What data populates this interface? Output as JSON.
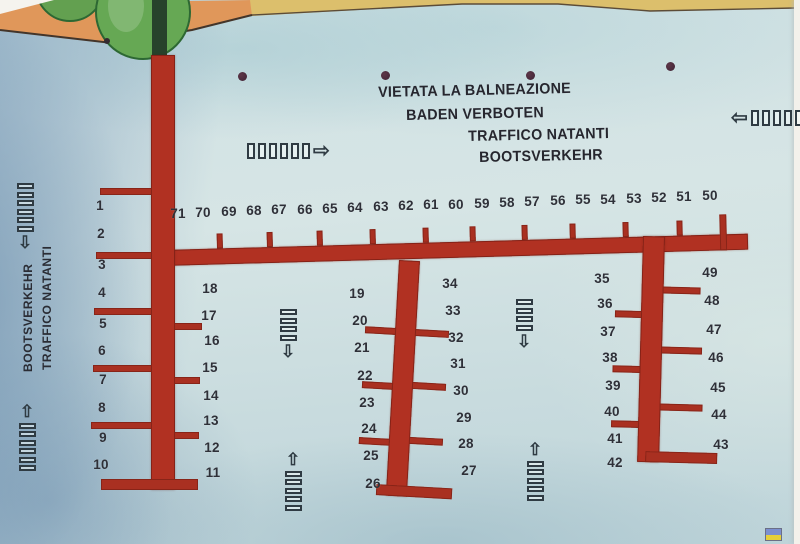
{
  "notice": {
    "lines": [
      {
        "text": "VIETATA LA BALNEAZIONE",
        "x": 378,
        "y": 84
      },
      {
        "text": "BADEN VERBOTEN",
        "x": 406,
        "y": 107
      },
      {
        "text": "TRAFFICO NATANTI",
        "x": 468,
        "y": 128
      },
      {
        "text": "BOOTSVERKEHR",
        "x": 479,
        "y": 149
      }
    ]
  },
  "side_label": {
    "lines": [
      "TRAFFICO NATANTI",
      "BOOTSVERKEHR"
    ]
  },
  "glyphs": {
    "up": "⇧",
    "down": "⇩",
    "left": "⇦",
    "right": "⇨"
  },
  "colors": {
    "water": "#cfe0e3",
    "water_deep": "#7fa3bf",
    "land": "#e0975a",
    "sand": "#dcbf6c",
    "tree": "#66a854",
    "pier": "#b13122",
    "ink": "#2e3038"
  },
  "berth_groups": [
    {
      "name": "berths-north-row",
      "items": [
        {
          "label": "71",
          "x": 178,
          "y": 206
        },
        {
          "label": "70",
          "x": 203,
          "y": 205
        },
        {
          "label": "69",
          "x": 229,
          "y": 204
        },
        {
          "label": "68",
          "x": 254,
          "y": 203
        },
        {
          "label": "67",
          "x": 279,
          "y": 202
        },
        {
          "label": "66",
          "x": 305,
          "y": 202
        },
        {
          "label": "65",
          "x": 330,
          "y": 201
        },
        {
          "label": "64",
          "x": 355,
          "y": 200
        },
        {
          "label": "63",
          "x": 381,
          "y": 199
        },
        {
          "label": "62",
          "x": 406,
          "y": 198
        },
        {
          "label": "61",
          "x": 431,
          "y": 197
        },
        {
          "label": "60",
          "x": 456,
          "y": 197
        },
        {
          "label": "59",
          "x": 482,
          "y": 196
        },
        {
          "label": "58",
          "x": 507,
          "y": 195
        },
        {
          "label": "57",
          "x": 532,
          "y": 194
        },
        {
          "label": "56",
          "x": 558,
          "y": 193
        },
        {
          "label": "55",
          "x": 583,
          "y": 192
        },
        {
          "label": "54",
          "x": 608,
          "y": 192
        },
        {
          "label": "53",
          "x": 634,
          "y": 191
        },
        {
          "label": "52",
          "x": 659,
          "y": 190
        },
        {
          "label": "51",
          "x": 684,
          "y": 189
        },
        {
          "label": "50",
          "x": 710,
          "y": 188
        }
      ]
    },
    {
      "name": "berths-west-outer",
      "items": [
        {
          "label": "1",
          "x": 100,
          "y": 198
        },
        {
          "label": "2",
          "x": 101,
          "y": 226
        },
        {
          "label": "3",
          "x": 102,
          "y": 257
        },
        {
          "label": "4",
          "x": 102,
          "y": 285
        },
        {
          "label": "5",
          "x": 103,
          "y": 316
        },
        {
          "label": "6",
          "x": 102,
          "y": 343
        },
        {
          "label": "7",
          "x": 103,
          "y": 372
        },
        {
          "label": "8",
          "x": 102,
          "y": 400
        },
        {
          "label": "9",
          "x": 103,
          "y": 430
        },
        {
          "label": "10",
          "x": 101,
          "y": 457
        }
      ]
    },
    {
      "name": "berths-pier1-east",
      "items": [
        {
          "label": "18",
          "x": 210,
          "y": 281
        },
        {
          "label": "17",
          "x": 209,
          "y": 308
        },
        {
          "label": "16",
          "x": 212,
          "y": 333
        },
        {
          "label": "15",
          "x": 210,
          "y": 360
        },
        {
          "label": "14",
          "x": 211,
          "y": 388
        },
        {
          "label": "13",
          "x": 211,
          "y": 413
        },
        {
          "label": "12",
          "x": 212,
          "y": 440
        },
        {
          "label": "11",
          "x": 213,
          "y": 465
        }
      ]
    },
    {
      "name": "berths-pier2-west",
      "items": [
        {
          "label": "19",
          "x": 357,
          "y": 286
        },
        {
          "label": "20",
          "x": 360,
          "y": 313
        },
        {
          "label": "21",
          "x": 362,
          "y": 340
        },
        {
          "label": "22",
          "x": 365,
          "y": 368
        },
        {
          "label": "23",
          "x": 367,
          "y": 395
        },
        {
          "label": "24",
          "x": 369,
          "y": 421
        },
        {
          "label": "25",
          "x": 371,
          "y": 448
        },
        {
          "label": "26",
          "x": 373,
          "y": 476
        }
      ]
    },
    {
      "name": "berths-pier2-east",
      "items": [
        {
          "label": "34",
          "x": 450,
          "y": 276
        },
        {
          "label": "33",
          "x": 453,
          "y": 303
        },
        {
          "label": "32",
          "x": 456,
          "y": 330
        },
        {
          "label": "31",
          "x": 458,
          "y": 356
        },
        {
          "label": "30",
          "x": 461,
          "y": 383
        },
        {
          "label": "29",
          "x": 464,
          "y": 410
        },
        {
          "label": "28",
          "x": 466,
          "y": 436
        },
        {
          "label": "27",
          "x": 469,
          "y": 463
        }
      ]
    },
    {
      "name": "berths-pier3-west",
      "items": [
        {
          "label": "35",
          "x": 602,
          "y": 271
        },
        {
          "label": "36",
          "x": 605,
          "y": 296
        },
        {
          "label": "37",
          "x": 608,
          "y": 324
        },
        {
          "label": "38",
          "x": 610,
          "y": 350
        },
        {
          "label": "39",
          "x": 613,
          "y": 378
        },
        {
          "label": "40",
          "x": 612,
          "y": 404
        },
        {
          "label": "41",
          "x": 615,
          "y": 431
        },
        {
          "label": "42",
          "x": 615,
          "y": 455
        }
      ]
    },
    {
      "name": "berths-pier3-east",
      "items": [
        {
          "label": "49",
          "x": 710,
          "y": 265
        },
        {
          "label": "48",
          "x": 712,
          "y": 293
        },
        {
          "label": "47",
          "x": 714,
          "y": 322
        },
        {
          "label": "46",
          "x": 716,
          "y": 350
        },
        {
          "label": "45",
          "x": 718,
          "y": 380
        },
        {
          "label": "44",
          "x": 719,
          "y": 407
        },
        {
          "label": "43",
          "x": 721,
          "y": 437
        }
      ]
    }
  ],
  "icons": [
    {
      "name": "traffic-lane-down-icon",
      "orient": "v",
      "arrow": "down",
      "x": 13,
      "y": 183,
      "bars": 6
    },
    {
      "name": "traffic-lane-up-icon",
      "orient": "v",
      "arrow": "up",
      "x": 15,
      "y": 403,
      "bars": 6
    },
    {
      "name": "traffic-lane-right-icon",
      "orient": "h",
      "arrow": "right",
      "x": 247,
      "y": 141,
      "bars": 6
    },
    {
      "name": "traffic-lane-left-icon",
      "orient": "h",
      "arrow": "left",
      "x": 731,
      "y": 108,
      "bars": 7
    },
    {
      "name": "traffic-lane-down-icon",
      "orient": "v",
      "arrow": "down",
      "x": 276,
      "y": 309,
      "bars": 4
    },
    {
      "name": "traffic-lane-up-icon",
      "orient": "v",
      "arrow": "up",
      "x": 281,
      "y": 451,
      "bars": 5
    },
    {
      "name": "traffic-lane-down-icon",
      "orient": "v",
      "arrow": "down",
      "x": 512,
      "y": 299,
      "bars": 4
    },
    {
      "name": "traffic-lane-up-icon",
      "orient": "v",
      "arrow": "up",
      "x": 523,
      "y": 441,
      "bars": 5
    }
  ],
  "dots": [
    {
      "x": 238,
      "y": 72
    },
    {
      "x": 381,
      "y": 71
    },
    {
      "x": 526,
      "y": 71
    },
    {
      "x": 666,
      "y": 62
    }
  ],
  "artifact": {
    "x": 765,
    "y": 528,
    "w": 15,
    "h": 11,
    "top_color": "#7b8fd0",
    "bottom_color": "#e5cf3b"
  },
  "layout": {
    "piers": [
      {
        "name": "main-pier",
        "x": 163,
        "y": 250,
        "w": 585,
        "h": 16,
        "rotate": -1.6,
        "stubs_up": [
          54,
          104,
          154,
          207,
          260,
          307,
          359,
          407,
          460,
          514
        ],
        "end_post": {
          "x": 557,
          "h": 36,
          "dy": -20
        }
      },
      {
        "name": "pier-west",
        "x": 151,
        "y": 55,
        "w": 24,
        "h": 435,
        "rotate": 0,
        "fingers_left": [
          {
            "y": 133,
            "len": 52
          },
          {
            "y": 197,
            "len": 56
          },
          {
            "y": 253,
            "len": 58
          },
          {
            "y": 310,
            "len": 59
          },
          {
            "y": 367,
            "len": 61
          }
        ],
        "fingers_right": [
          {
            "y": 268,
            "len": 28
          },
          {
            "y": 322,
            "len": 26
          },
          {
            "y": 377,
            "len": 25
          }
        ],
        "cap": {
          "dx": -50,
          "w": 97
        }
      },
      {
        "name": "pier-middle",
        "x": 399,
        "y": 260,
        "w": 21,
        "h": 236,
        "rotate": 3.2,
        "fingers_left": [
          {
            "y": 68,
            "len": 31
          },
          {
            "y": 123,
            "len": 31
          },
          {
            "y": 179,
            "len": 31
          }
        ],
        "fingers_right": [
          {
            "y": 68,
            "len": 34
          },
          {
            "y": 121,
            "len": 34
          },
          {
            "y": 176,
            "len": 34
          }
        ],
        "cap": {
          "dx": -10,
          "w": 76
        }
      },
      {
        "name": "pier-east",
        "x": 643,
        "y": 236,
        "w": 22,
        "h": 226,
        "rotate": 1.5,
        "fingers_left": [
          {
            "y": 75,
            "len": 27
          },
          {
            "y": 130,
            "len": 28
          },
          {
            "y": 185,
            "len": 28
          }
        ],
        "fingers_right": [
          {
            "y": 50,
            "len": 38
          },
          {
            "y": 110,
            "len": 41
          },
          {
            "y": 167,
            "len": 43
          }
        ],
        "cap": {
          "dx": 8,
          "w": 72
        }
      }
    ]
  }
}
